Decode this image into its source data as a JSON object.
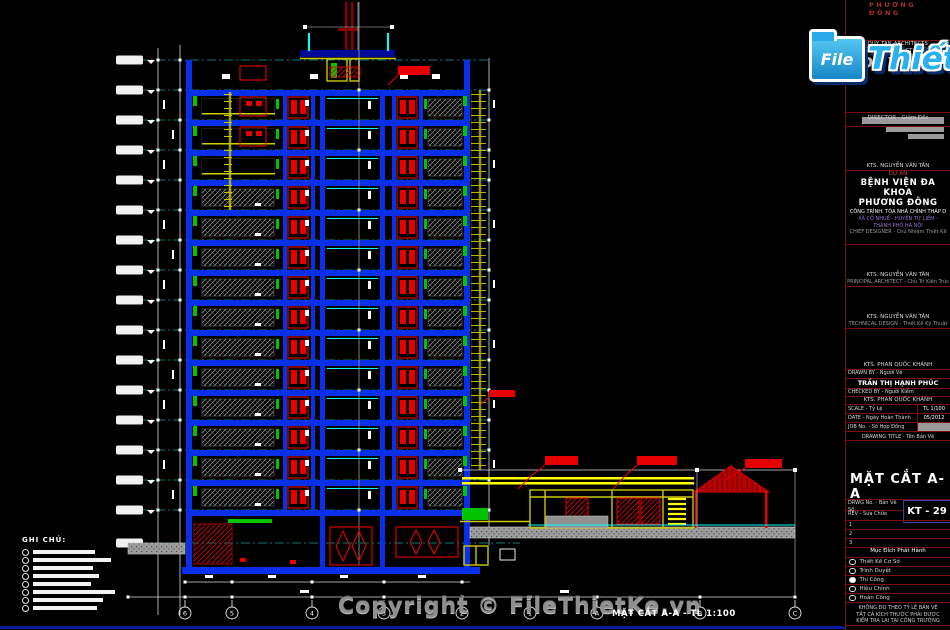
{
  "top_label": "PHƯƠNG ĐÔNG",
  "logo": {
    "folder_text": "File",
    "name": "Thiết Kế",
    "tld": ".vn"
  },
  "copyright": "Copyright © FileThietKe.vn",
  "drawing": {
    "caption": "MẶT CẮT A-A - TL 1:100",
    "notes_title": "GHI CHÚ:",
    "grid_bubbles": [
      "6",
      "5",
      "4",
      "3",
      "2",
      "1",
      "A",
      "B",
      "C"
    ]
  },
  "titleblock": {
    "firm_line1": "DUY TAN ARCHITECTS",
    "firm_line2": "DESIGN & CONSTRUCTION Co., Ltd",
    "firm_logo": "DUYTAN",
    "director_label": "DIRECTOR - Giám Đốc",
    "director_name": "KTS. NGUYỄN VĂN TÂN",
    "project_label": "DỰ ÁN",
    "project_name1": "BỆNH VIỆN ĐA KHOA",
    "project_name2": "PHƯƠNG ĐÔNG",
    "work_item": "CÔNG TRÌNH: TÒA NHÀ CHÍNH THÁP D",
    "address1": "XÃ CỔ NHUẾ - HUYỆN TỪ LIÊM -",
    "address2": "THÀNH PHỐ HÀ NỘI",
    "chief_label": "CHIEF DESIGNER - Chủ Nhiệm Thiết Kế",
    "principal_name": "KTS. NGUYỄN VĂN TÂN",
    "principal_label": "PRINCIPAL ARCHITECT - Chủ Trì Kiến Trúc",
    "technical_name": "KTS. NGUYỄN VĂN TÂN",
    "technical_label": "TECHNICAL DESIGN - Thiết Kế Kỹ Thuật",
    "drawn_chief_name": "KTS. PHAN QUỐC KHÁNH",
    "drawn_label": "DRAWN BY - Người Vẽ",
    "drawn_name": "TRẦN THỊ HẠNH PHÚC",
    "checked_label": "CHECKED BY - Người Kiểm",
    "checked_name": "KTS. PHAN QUỐC KHÁNH",
    "scale_label": "SCALE - Tỷ Lệ",
    "scale_value": "TL 1/100",
    "date_label": "DATE - Ngày Hoàn Thành",
    "date_value": "05/2012",
    "job_label": "JOB No. - Số Hợp Đồng",
    "title_label": "DRAWING TITLE - Tên Bản Vẽ",
    "drawing_title": "MẶT CẮT A-A",
    "drwg_label": "DRWG No. - Bản Vẽ Số",
    "rev_label": "REV - Sửa Chữa",
    "drwg_no": "KT - 29",
    "rev_rows": [
      "1",
      "2",
      "3"
    ],
    "issue_title": "Mục Đích Phát Hành",
    "issue_options": [
      {
        "label": "Thiết Kế Cơ Sở",
        "checked": false
      },
      {
        "label": "Trình Duyệt",
        "checked": false
      },
      {
        "label": "Thi Công",
        "checked": true
      },
      {
        "label": "Hiệu Chỉnh",
        "checked": false
      },
      {
        "label": "Hoàn Công",
        "checked": false
      }
    ],
    "note_line1": "KHÔNG ĐO THEO TỶ LỆ BẢN VẼ",
    "note_line2": "TẤT CẢ KÍCH THƯỚC PHẢI ĐƯỢC",
    "note_line3": "KIỂM TRA LẠI TẠI CÔNG TRƯỜNG"
  }
}
